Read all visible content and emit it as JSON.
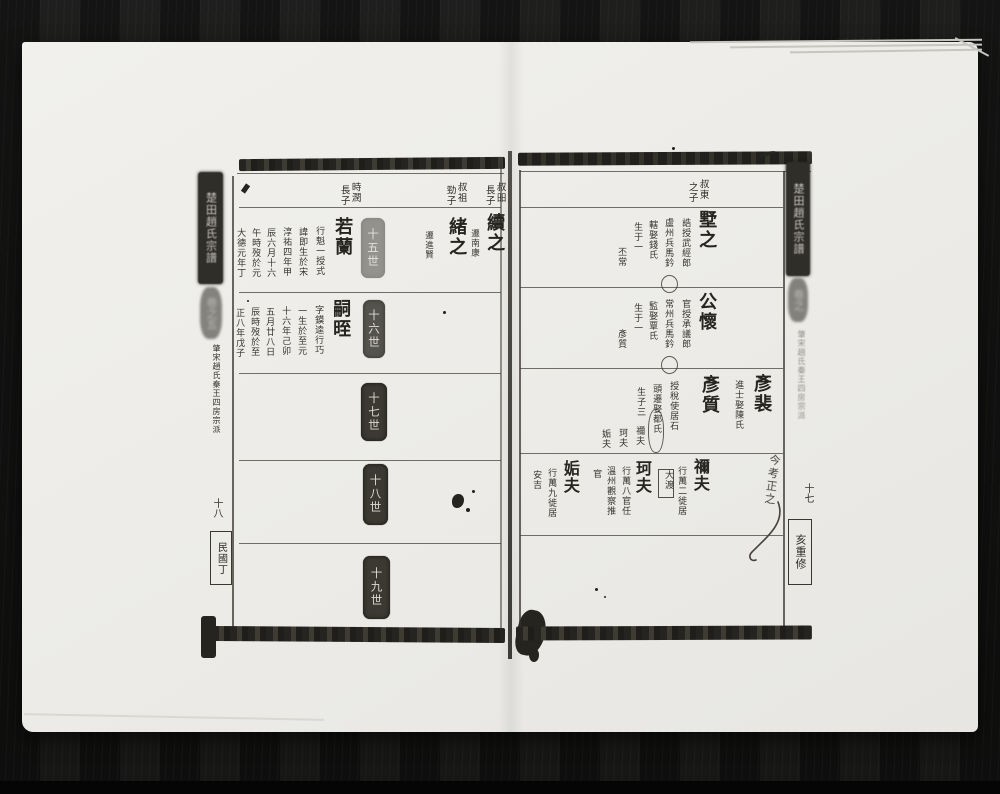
{
  "book": {
    "left_page": {
      "spine": {
        "title": "楚田趙氏宗譜",
        "volume": "卷之五",
        "section": "肇宋趙氏秦王四房宗派",
        "page_number": "十八",
        "edition": "民國丁"
      },
      "labels": [
        {
          "r": "叔昍",
          "l": "長子"
        },
        {
          "r": "叔祖",
          "l": "勁子"
        },
        {
          "r": "時潤",
          "l": "長子"
        }
      ],
      "generation_stamps": [
        "十五世",
        "十六世",
        "十七世",
        "十八世",
        "十九世"
      ],
      "entries": {
        "xuzhi": {
          "name": "續之",
          "note": "遷南康"
        },
        "xu2zhi": {
          "name": "緒之",
          "note": "遷進賢"
        },
        "ruolan": {
          "name": "若蘭",
          "details": [
            "行魁一授式",
            "諱即生於宋",
            "淳祐四年甲",
            "辰六月十六",
            "午時歿於元",
            "大德元年丁"
          ]
        },
        "sizhi": {
          "name": "嗣晊",
          "details": [
            "字鏌逵行巧",
            "一生於至元",
            "十六年己卯",
            "五月廿八日",
            "辰時歿於至",
            "正八年戊子"
          ]
        }
      }
    },
    "right_page": {
      "spine": {
        "title": "楚田趙氏宗譜",
        "volume": "卷之",
        "section": "肇宋趙氏秦王四房宗派",
        "page_number": "十七",
        "edition": "亥重修"
      },
      "labels": [
        {
          "r": "叔東",
          "l": "之子"
        }
      ],
      "entries": {
        "shuzhi": {
          "name": "墅之",
          "details": [
            "誥授武經郎",
            "盧州兵馬鈐",
            "轄娶錢氏",
            "生于一",
            "丕常"
          ]
        },
        "gonghuai": {
          "name": "公懷",
          "details": [
            "官授承議郎",
            "常州兵馬鈐",
            "監娶覃氏",
            "生于一",
            "彥質"
          ]
        },
        "yanpei": {
          "name": "彥裴",
          "details": [
            "進士娶陳氏"
          ]
        },
        "yanzhi": {
          "name": "彥質",
          "details": [
            "授稅使居石",
            "頭遷娶都氏",
            "生子三"
          ],
          "sons": [
            "禰夫",
            "珂夫",
            "姤夫"
          ]
        },
        "mifu": {
          "name": "禰夫",
          "details": [
            "行萬二徙居"
          ],
          "boxed_note": "大渡"
        },
        "kefu": {
          "name": "珂夫",
          "details": [
            "行萬八官任",
            "溫州觀察推",
            "官"
          ]
        },
        "goufu": {
          "name": "姤夫",
          "details": [
            "行萬九徙居",
            "安吉"
          ]
        }
      },
      "handwritten_note": "今考正之"
    }
  }
}
